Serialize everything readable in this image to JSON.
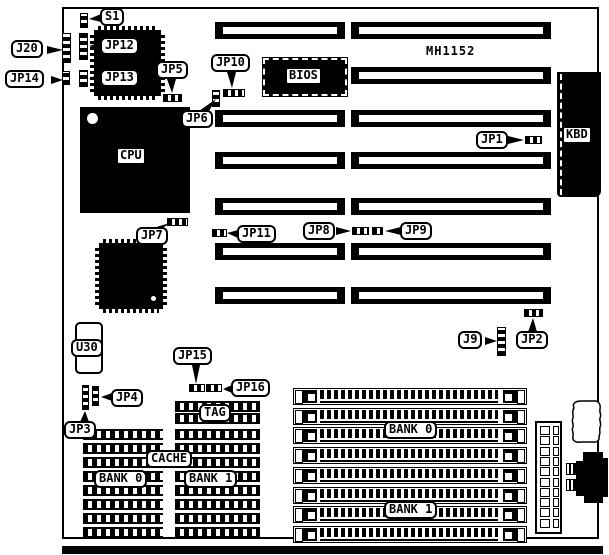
{
  "board": {
    "model": "MH1152"
  },
  "chips": {
    "cpu": "CPU",
    "bios": "BIOS",
    "kbd": "KBD",
    "u30": "U30",
    "tag": "TAG",
    "cache": "CACHE"
  },
  "banks": {
    "cache_bank0": "BANK 0",
    "cache_bank1": "BANK 1",
    "simm_bank0": "BANK 0",
    "simm_bank1": "BANK 1"
  },
  "callouts": {
    "s1": "S1",
    "j20": "J20",
    "jp12": "JP12",
    "jp13": "JP13",
    "jp14": "JP14",
    "jp5": "JP5",
    "jp10": "JP10",
    "jp6": "JP6",
    "jp1": "JP1",
    "jp7": "JP7",
    "jp11": "JP11",
    "jp8": "JP8",
    "jp9": "JP9",
    "j9": "J9",
    "jp2": "JP2",
    "jp15": "JP15",
    "jp16": "JP16",
    "jp4": "JP4",
    "jp3": "JP3"
  },
  "slots": {
    "isa_left_count": 6,
    "isa_right_count": 7,
    "simm_count": 8,
    "cache_rows_per_bank": 8,
    "tag_rows": 2,
    "power_pin_rows": 10
  }
}
